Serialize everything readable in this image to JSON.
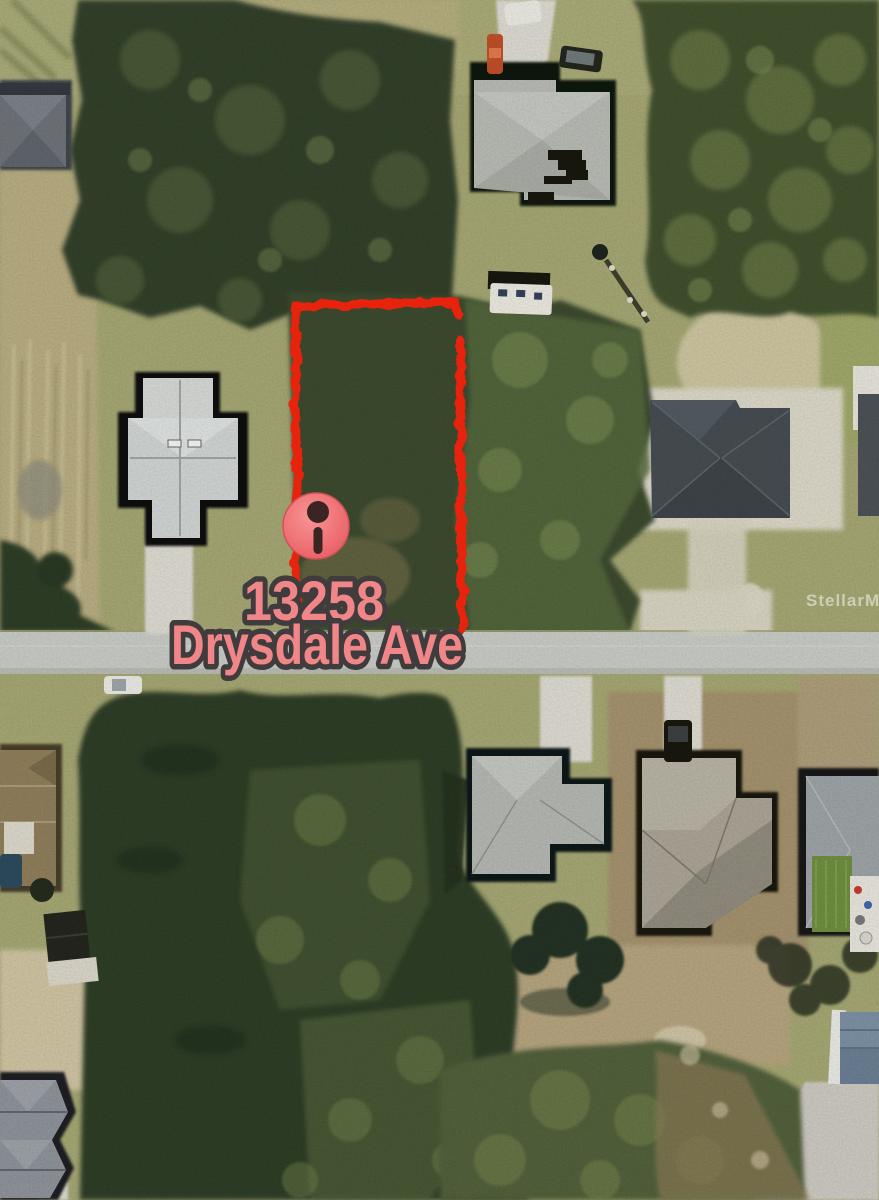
{
  "map": {
    "type": "satellite-aerial",
    "marker": {
      "icon": "location-pin-icon",
      "address_line1": "13258",
      "address_line2": "Drysdale Ave"
    },
    "watermark": {
      "text": "StellarMLS"
    },
    "lot": {
      "boundary_color": "#e7220d"
    },
    "colors": {
      "marker_fill": "#ef7173",
      "marker_glyph": "#3a2522",
      "label_fill": "#f08688",
      "label_outline": "#403c3d",
      "road": "#c6c9c3",
      "grass": "#a3a572",
      "vegetation_dark": "#32402a",
      "watermark_white": "rgba(255,255,255,0.5)"
    }
  }
}
